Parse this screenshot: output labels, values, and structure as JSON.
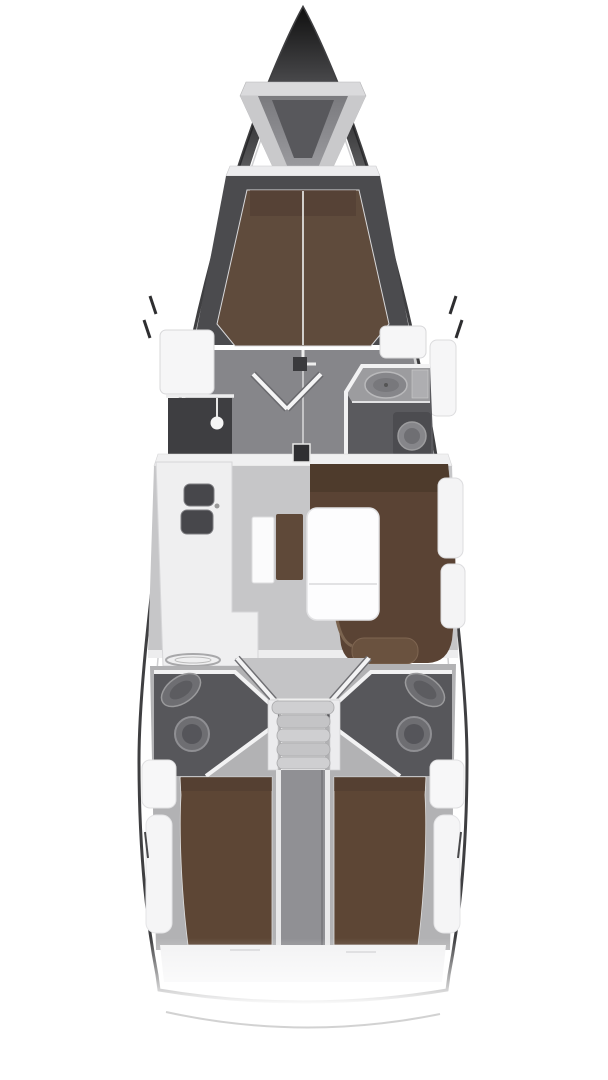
{
  "diagram": {
    "title": "sailing-yacht-interior-floor-plan",
    "type": "boat-floor-plan",
    "orientation": "bow-up",
    "features": {
      "bow": "anchor-locker",
      "forward_cabin": "v-berth-double-with-center-split",
      "forward_wardrobe": "port-hanging-locker-with-lamp",
      "forward_head": "starboard-sink-and-toilet",
      "cabin_doors": "double-doors-open-v",
      "mast_base": "centerline-at-main-bulkhead",
      "galley": "port-l-shape-double-sink-and-stove",
      "nav_station": "chart-table-with-seat",
      "salon": "starboard-l-settee-with-folding-table",
      "aft_head_port": "sink-and-toilet",
      "aft_head_starboard": "sink-and-toilet",
      "companionway": "five-step-ladder",
      "engine_compartment": "centerline-below-steps",
      "aft_cabin_port": "double-berth",
      "aft_cabin_starboard": "double-berth",
      "stern": "transom-with-swim-platform-arc"
    },
    "palette": {
      "background": "#ffffff",
      "hull_stroke": "#3f3f41",
      "deck_white": "#f7f7f8",
      "forepeak_dark": "#4b4b4e",
      "cabin_floor_gray": "#86868a",
      "salon_floor_gray": "#c6c6c8",
      "landing_gray": "#c4c4c6",
      "aft_wall_gray": "#b2b2b4",
      "head_gray": "#57575b",
      "fwd_head_gray": "#5a5a5e",
      "counter_gray": "#9c9c9f",
      "wardrobe_dark": "#3e3e41",
      "sink_dark": "#47474b",
      "fixture_gray": "#6e6e72",
      "berth_fwd_brown": "#5f4b3c",
      "berth_aft_brown": "#5d4635",
      "settee_brown": "#5a4334",
      "settee_back_brown": "#4c392c",
      "cushion_brown": "#6a523f",
      "nav_seat_brown": "#5f4939",
      "table_white": "#fdfdfe",
      "counter_white": "#efeff0",
      "wall_white": "#f2f2f3",
      "step_gray": "#cfcfd1",
      "engine_gray": "#909094",
      "arc_gray": "#cacaca"
    }
  }
}
